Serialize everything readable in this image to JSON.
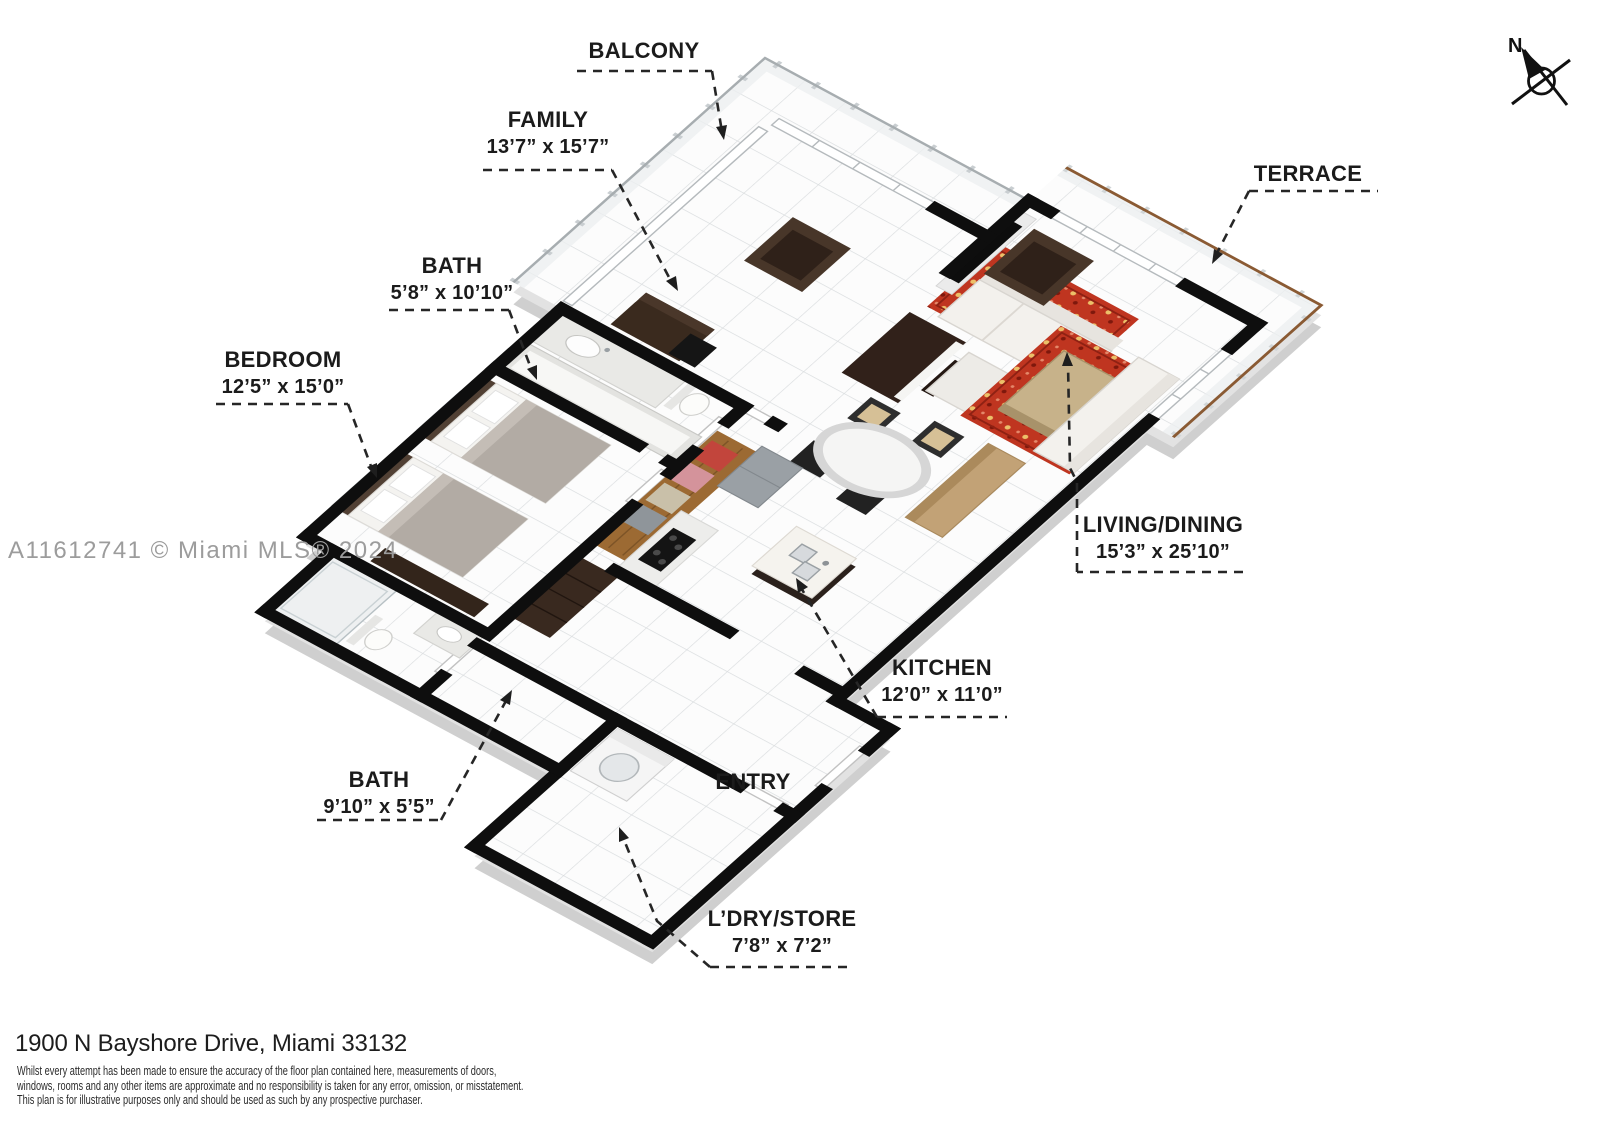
{
  "compass": {
    "label": "N"
  },
  "watermark": {
    "text": "A11612741 © Miami MLS® 2024",
    "color": "#9c9c9c"
  },
  "rooms": [
    {
      "id": "balcony",
      "name": "BALCONY",
      "dims": ""
    },
    {
      "id": "family",
      "name": "FAMILY",
      "dims": "13’7” x 15’7”"
    },
    {
      "id": "bath1",
      "name": "BATH",
      "dims": "5’8” x 10’10”"
    },
    {
      "id": "bedroom",
      "name": "BEDROOM",
      "dims": "12’5” x 15’0”"
    },
    {
      "id": "terrace",
      "name": "TERRACE",
      "dims": ""
    },
    {
      "id": "living",
      "name": "LIVING/DINING",
      "dims": "15’3” x 25’10”"
    },
    {
      "id": "kitchen",
      "name": "KITCHEN",
      "dims": "12’0” x 11’0”"
    },
    {
      "id": "entry",
      "name": "ENTRY",
      "dims": ""
    },
    {
      "id": "bath2",
      "name": "BATH",
      "dims": "9’10” x 5’5”"
    },
    {
      "id": "laundry",
      "name": "L’DRY/STORE",
      "dims": "7’8” x 7’2”"
    }
  ],
  "footer": {
    "address": "1900 N Bayshore Drive, Miami 33132",
    "disclaimer_lines": [
      "Whilst every attempt has been made to ensure the accuracy of the floor plan contained here, measurements of doors,",
      "windows, rooms and any other items are approximate and no responsibility is taken for any error, omission, or misstatement.",
      "This plan is for illustrative purposes only and should be used as such by any prospective purchaser."
    ]
  },
  "colors": {
    "wall": "#0e0e0e",
    "floor": "#fcfcfc",
    "slab": "#d3d3d3",
    "rug": "#bf3520",
    "wood_cabinet": "#9c6a33",
    "wood_light": "#c2a276",
    "dark_furniture": "#483629",
    "terrace_rail": "#8a5a33",
    "label_text": "#1b1b1b",
    "watermark": "#9c9c9c"
  }
}
